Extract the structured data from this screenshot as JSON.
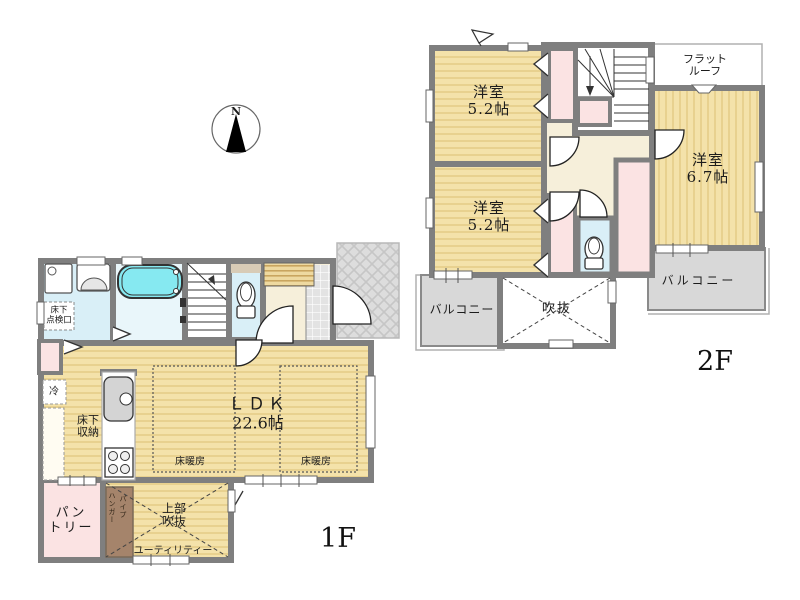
{
  "compass": {
    "north_label": "N"
  },
  "floor_2f": {
    "label": "2F",
    "bedroom_top": {
      "line1": "洋室",
      "line2": "5.2帖"
    },
    "bedroom_mid": {
      "line1": "洋室",
      "line2": "5.2帖"
    },
    "bedroom_right": {
      "line1": "洋室",
      "line2": "6.7帖"
    },
    "flat_roof": {
      "line1": "フラット",
      "line2": "ルーフ"
    },
    "balcony_left": {
      "label": "バルコニー"
    },
    "balcony_right": {
      "label": "バルコニー"
    },
    "void": {
      "label": "吹抜"
    }
  },
  "floor_1f": {
    "label": "1F",
    "ldk": {
      "line1": "ＬＤＫ",
      "line2": "22.6帖"
    },
    "floor_heating_left": {
      "label": "床暖房"
    },
    "floor_heating_right": {
      "label": "床暖房"
    },
    "underfloor_hatch": {
      "line1": "床下",
      "line2": "点検口"
    },
    "underfloor_storage": {
      "line1": "床下",
      "line2": "収納"
    },
    "refrigerator": {
      "label": "冷"
    },
    "pantry": {
      "line1": "パン",
      "line2": "トリー"
    },
    "upper_void": {
      "line1": "上部",
      "line2": "吹抜"
    },
    "utility": {
      "label": "ユーティリティー"
    },
    "hanger_pipe": {
      "col1": "ハンガー",
      "col2": "パイプ"
    }
  },
  "colors": {
    "wall": "#7f7f7f",
    "floor_yellow": "#f4e2aa",
    "floor_stripe": "#e8d18f",
    "closet_pink": "#fbe3e3",
    "wet_area_blue": "#d9eff7",
    "bath_blue": "#e9f6fa",
    "tub_cyan": "#86e9f1",
    "hall_cream": "#f6efda",
    "balcony_gray": "#d8d8d8",
    "shelf_brown": "#a5846b",
    "tatami_tan": "#eed9a0"
  }
}
